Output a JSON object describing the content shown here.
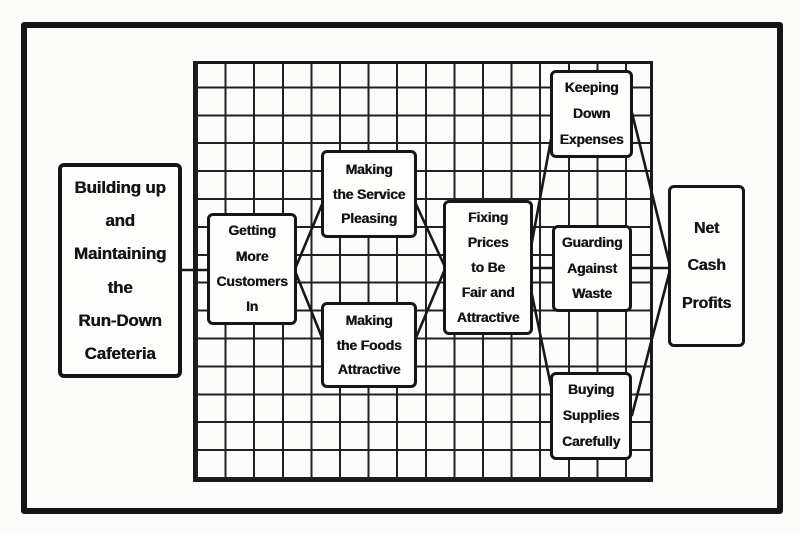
{
  "figure": {
    "type": "flow-diagram",
    "description": "Printed flowchart on graph-paper background showing how cafeteria management activities lead to net cash profits",
    "colors": {
      "ink": "#161616",
      "paper": "#fcfcfa"
    }
  },
  "nodes": {
    "building": {
      "label": "Building up\nand\nMaintaining\nthe\nRun-Down\nCafeteria"
    },
    "customers": {
      "label": "Getting\nMore\nCustomers\nIn"
    },
    "service": {
      "label": "Making\nthe Service\nPleasing"
    },
    "foods": {
      "label": "Making\nthe Foods\nAttractive"
    },
    "fixing": {
      "label": "Fixing\nPrices\nto Be\nFair and\nAttractive"
    },
    "expenses": {
      "label": "Keeping\nDown\nExpenses"
    },
    "guarding": {
      "label": "Guarding\nAgainst\nWaste"
    },
    "supplies": {
      "label": "Buying\nSupplies\nCarefully"
    },
    "netcash": {
      "label": "Net\nCash\nProfits"
    }
  },
  "edges": [
    {
      "from": "building",
      "to": "customers"
    },
    {
      "from": "customers",
      "to": "service"
    },
    {
      "from": "customers",
      "to": "foods"
    },
    {
      "from": "service",
      "to": "fixing"
    },
    {
      "from": "foods",
      "to": "fixing"
    },
    {
      "from": "fixing",
      "to": "expenses"
    },
    {
      "from": "fixing",
      "to": "guarding"
    },
    {
      "from": "fixing",
      "to": "supplies"
    },
    {
      "from": "expenses",
      "to": "netcash"
    },
    {
      "from": "guarding",
      "to": "netcash"
    },
    {
      "from": "supplies",
      "to": "netcash"
    }
  ]
}
